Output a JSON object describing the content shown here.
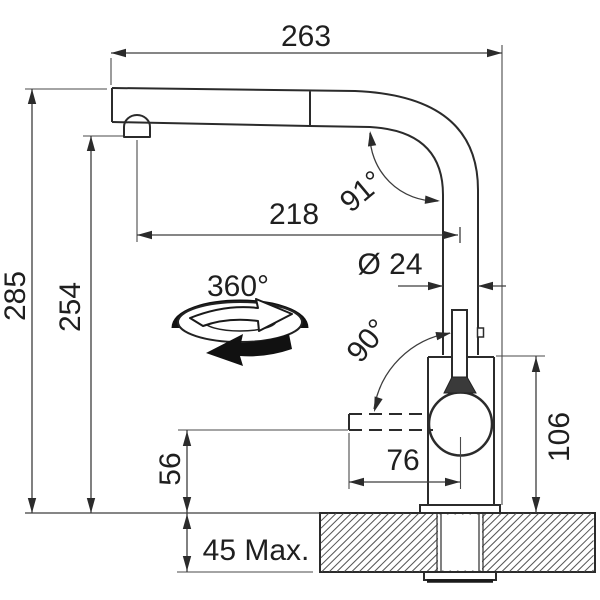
{
  "drawing": {
    "type": "faucet-installation-dimension-drawing",
    "dimensions": {
      "overall_depth": "263",
      "overall_height": "285",
      "spout_outlet_height": "254",
      "spout_reach": "218",
      "spout_bend_angle": "91°",
      "pipe_diameter": "Ø 24",
      "swivel_angle": "360°",
      "spray_swing_angle": "90°",
      "body_height": "106",
      "spray_outlet_height": "56",
      "spray_reach": "76",
      "max_counter_thickness": "45 Max."
    },
    "colors": {
      "line": "#2b2b2b",
      "dimension_line": "#3d3d3d",
      "text": "#1f1f1f",
      "background": "#ffffff"
    }
  }
}
